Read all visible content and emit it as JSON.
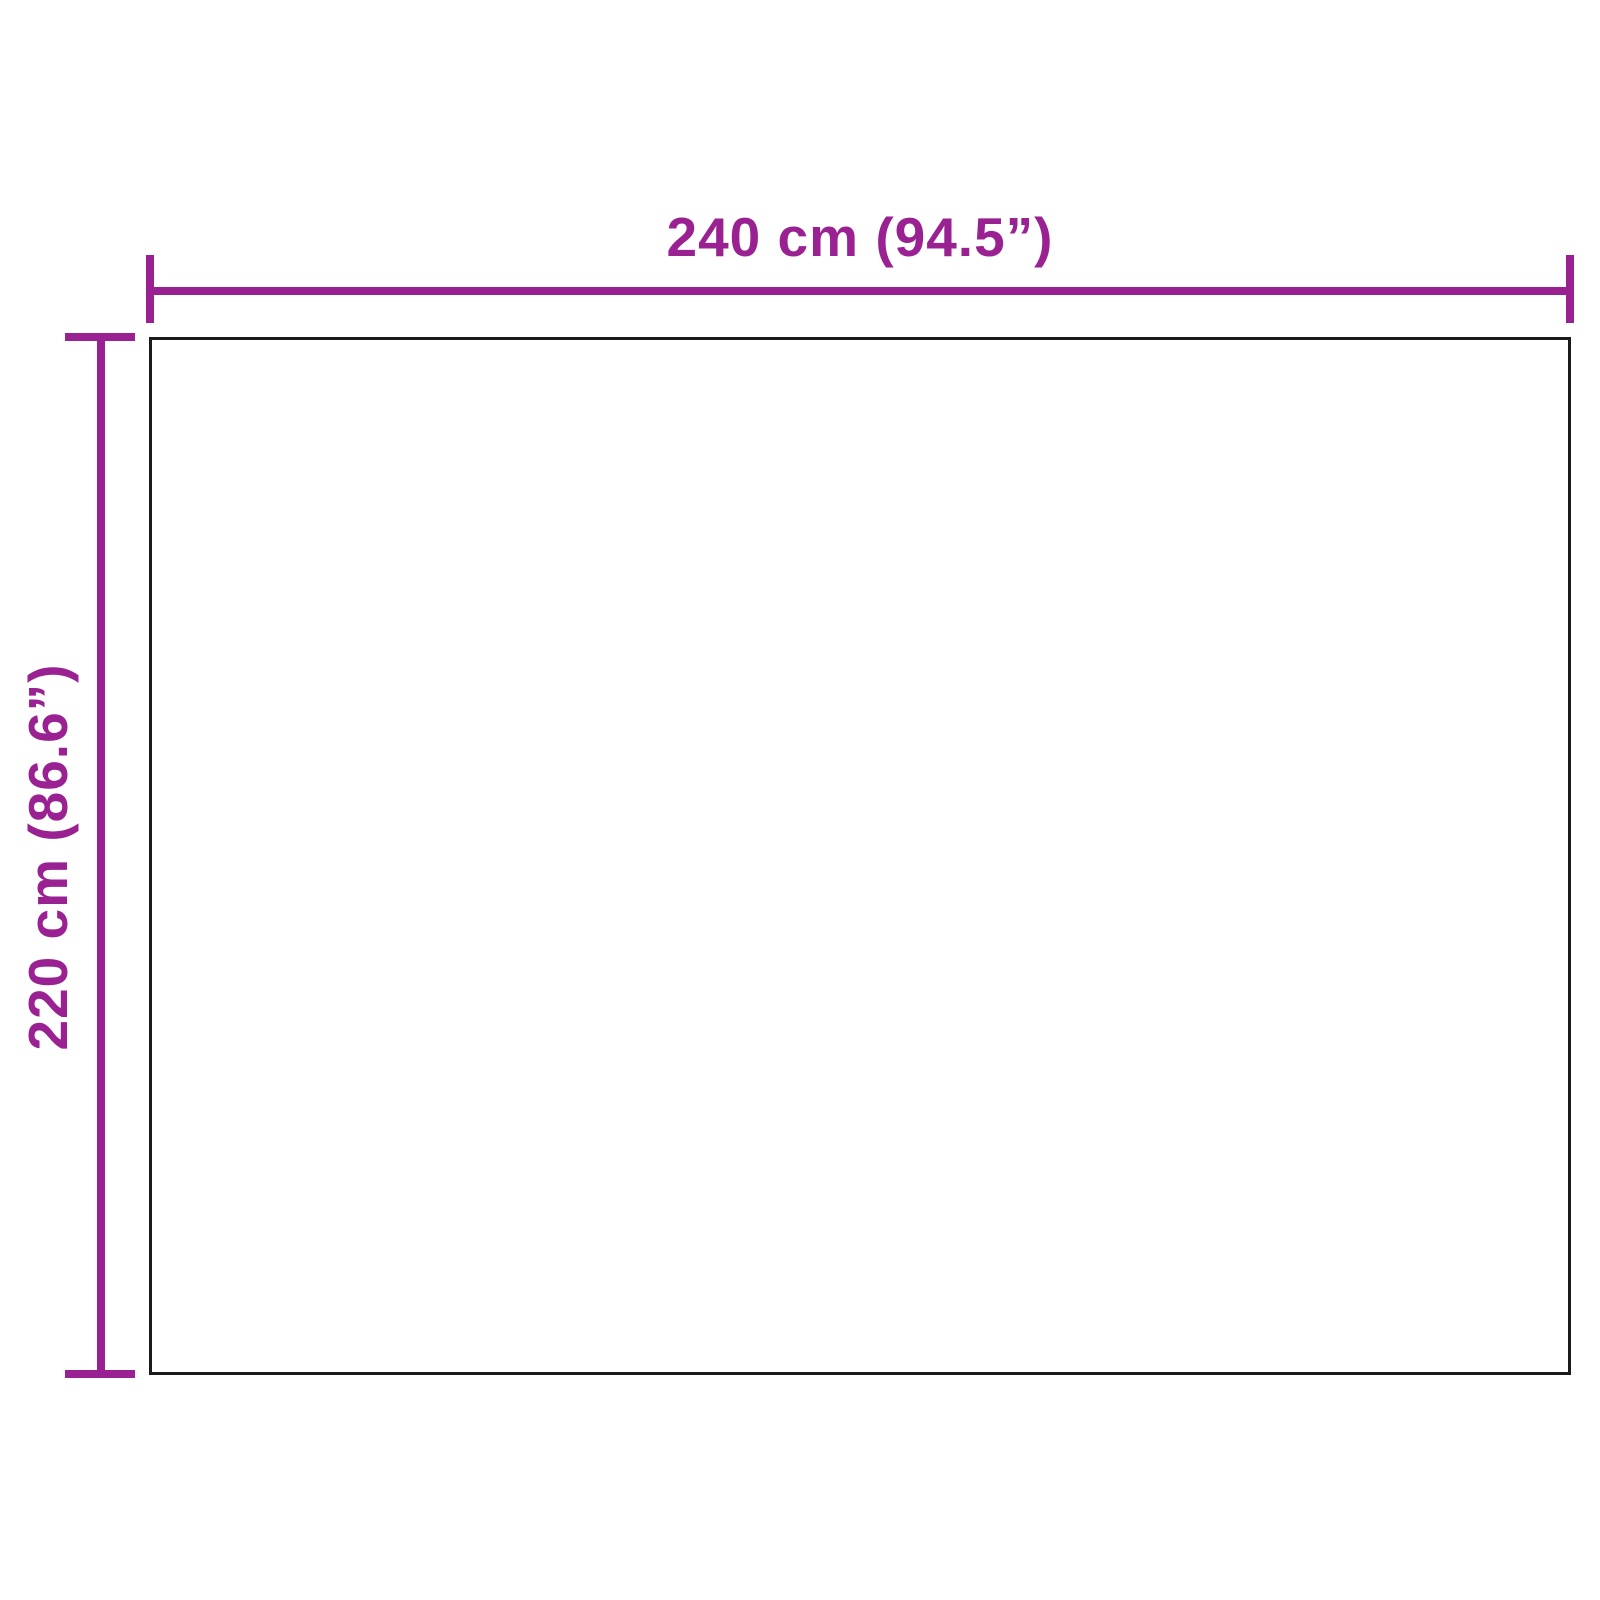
{
  "colors": {
    "accent": "#9A2191",
    "outline": "#1B1B1B",
    "bg": "#FFFFFF"
  },
  "diagram": {
    "kind": "product-dimension-diagram",
    "width_dimension": {
      "label": "240 cm (94.5”)",
      "value_cm": 240,
      "value_inches": 94.5
    },
    "height_dimension": {
      "label": "220 cm (86.6”)",
      "value_cm": 220,
      "value_inches": 86.6
    }
  }
}
